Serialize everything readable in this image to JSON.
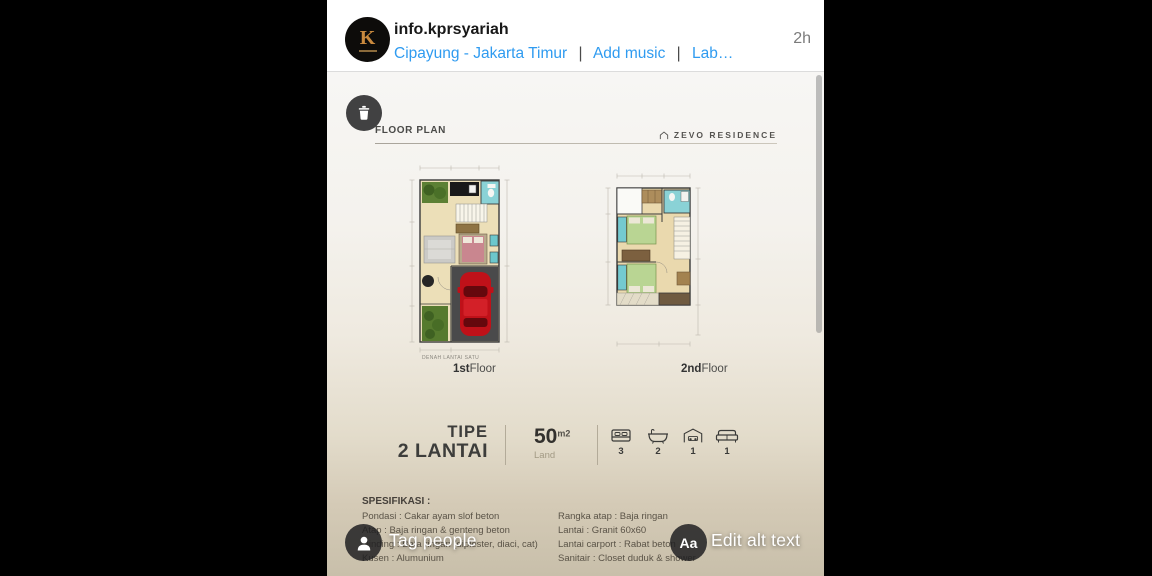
{
  "header": {
    "username": "info.kprsyariah",
    "location": "Cipayung - Jakarta Timur",
    "separator": "|",
    "add_music": "Add music",
    "label_link": "Lab…",
    "timestamp": "2h",
    "avatar_initial": "K"
  },
  "poster": {
    "section_title": "FLOOR PLAN",
    "brand": "ZEVO RESIDENCE",
    "floor1_caption": "DENAH LANTAI SATU",
    "floor1_label_bold": "1st",
    "floor1_label": "Floor",
    "floor2_label_bold": "2nd",
    "floor2_label": "Floor",
    "type_line1": "TIPE",
    "type_line2": "2 LANTAI",
    "area_value": "50",
    "area_unit": "m2",
    "area_label": "Land",
    "amenities": [
      {
        "icon": "bed-icon",
        "count": "3"
      },
      {
        "icon": "bathtub-icon",
        "count": "2"
      },
      {
        "icon": "garage-icon",
        "count": "1"
      },
      {
        "icon": "sofa-icon",
        "count": "1"
      }
    ],
    "specs_heading": "SPESIFIKASI :",
    "specs_left": [
      "Pondasi : Cakar ayam slof beton",
      "Atap : Baja ringan & genteng beton",
      "Dinding : Bata ringan (diplester, diaci, cat)",
      "Kusen : Alumunium"
    ],
    "specs_right": [
      "Rangka atap : Baja ringan",
      "Lantai : Granit 60x60",
      "Lantai carport : Rabat beton",
      "Sanitair : Closet duduk & shower"
    ]
  },
  "overlay": {
    "tag_people": "Tag people",
    "edit_alt_text": "Edit alt text",
    "aa": "Aa"
  },
  "colors": {
    "link_blue": "#2f9bf0",
    "overlay_circle": "#1e1e20",
    "accent_gold": "#c98a3e"
  }
}
